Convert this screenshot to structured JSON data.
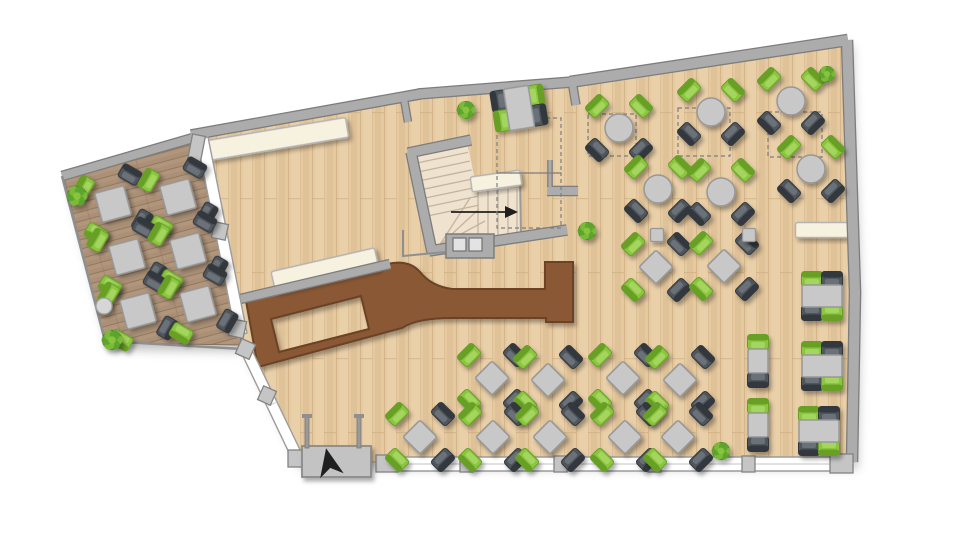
{
  "canvas": {
    "w": 960,
    "h": 556
  },
  "plan_title": "restaurant-floor-plan",
  "palette": {
    "floor": "#E5C9A1",
    "floorLine": "#C8A678",
    "floorLight": "#EFD9B3",
    "floorDark": "#DBBB90",
    "terrace": "#AB9077",
    "terraceLine": "#8A735A",
    "terraceBand": "#B79C80",
    "wall": "#ACACAC",
    "wallEdge": "#7D7D7D",
    "bar": "#8A5836",
    "barEdge": "#6B4226",
    "bench": "#F7F1DF",
    "benchEdge": "#B3B3B3",
    "table": "#C8C8C8",
    "tableEdge": "#979797",
    "chairGreen": "#8CC63F",
    "chairGreenBack": "#67A028",
    "chairGreenHi": "#A8D765",
    "chairDark": "#50565C",
    "chairDarkBack": "#33383D",
    "chairDarkHi": "#6E757D",
    "stair": "#EFE3D0",
    "stairLine": "#C3B49D",
    "window": "#FFFFFF",
    "windowFrame": "#9C9C9C",
    "block": "#C5C5C5",
    "blockEdge": "#838383",
    "mat": "#C3C3C3",
    "matEdge": "#8A8A8A",
    "arrow": "#1F1F1F",
    "dash": "#7E7E7E",
    "plantDark": "#44821F",
    "plantMid": "#5FA32E",
    "plantLight": "#7CBD3A",
    "plantTop": "#8CC63F"
  },
  "floorPoly": [
    [
      191,
      134
    ],
    [
      420,
      93
    ],
    [
      571,
      81
    ],
    [
      847,
      40
    ],
    [
      855,
      292
    ],
    [
      852,
      462
    ],
    [
      297,
      462
    ],
    [
      243,
      348
    ],
    [
      200,
      139
    ]
  ],
  "terracePoly": [
    [
      63,
      174
    ],
    [
      196,
      136
    ],
    [
      242,
      345
    ],
    [
      105,
      343
    ]
  ],
  "walls": [
    {
      "p": [
        [
          62,
          176
        ],
        [
          193,
          138
        ]
      ],
      "w": 8
    },
    {
      "p": [
        [
          191,
          135
        ],
        [
          420,
          94
        ]
      ],
      "w": 9
    },
    {
      "p": [
        [
          418,
          94
        ],
        [
          572,
          82
        ]
      ],
      "w": 9
    },
    {
      "p": [
        [
          570,
          82
        ],
        [
          848,
          40
        ]
      ],
      "w": 10
    },
    {
      "p": [
        [
          847,
          40
        ],
        [
          855,
          292
        ],
        [
          852,
          462
        ]
      ],
      "w": 10
    },
    {
      "p": [
        [
          404,
          99
        ],
        [
          408,
          122
        ]
      ],
      "w": 6
    },
    {
      "p": [
        [
          572,
          81
        ],
        [
          576,
          105
        ]
      ],
      "w": 7
    },
    {
      "p": [
        [
          236,
          300
        ],
        [
          390,
          264
        ]
      ],
      "w": 8
    },
    {
      "p": [
        [
          550,
          160
        ],
        [
          550,
          191
        ]
      ],
      "w": 3
    },
    {
      "p": [
        [
          547,
          191
        ],
        [
          578,
          191
        ]
      ],
      "w": 8
    },
    {
      "p": [
        [
          411,
          152
        ],
        [
          432,
          252
        ]
      ],
      "w": 9
    },
    {
      "p": [
        [
          408,
          153
        ],
        [
          471,
          140
        ]
      ],
      "w": 9
    },
    {
      "p": [
        [
          429,
          251
        ],
        [
          567,
          230
        ]
      ],
      "w": 9
    }
  ],
  "thinLines": [
    {
      "p": [
        [
          62,
          176
        ],
        [
          105,
          341
        ],
        [
          242,
          349
        ]
      ],
      "w": 2.5
    },
    {
      "p": [
        [
          403,
          230
        ],
        [
          403,
          256
        ],
        [
          445,
          252
        ]
      ],
      "w": 2
    }
  ],
  "nook": {
    "rect": [
      446,
      234,
      48,
      24
    ],
    "squares": [
      [
        453,
        238,
        13,
        13
      ],
      [
        469,
        238,
        13,
        13
      ]
    ]
  },
  "windows": {
    "bands": [
      {
        "poly": [
          [
            197,
            140
          ],
          [
            208,
            137
          ],
          [
            247,
            333
          ],
          [
            236,
            336
          ]
        ]
      },
      {
        "poly": [
          [
            241,
            352
          ],
          [
            251,
            348
          ],
          [
            303,
            456
          ],
          [
            293,
            461
          ]
        ]
      },
      {
        "poly": [
          [
            398,
            457
          ],
          [
            832,
            457
          ],
          [
            832,
            471
          ],
          [
            398,
            471
          ]
        ]
      }
    ],
    "blocks": [
      [
        190,
        135,
        13,
        26,
        11
      ],
      [
        213,
        223,
        14,
        16,
        12
      ],
      [
        230,
        320,
        15,
        17,
        12
      ],
      [
        238,
        341,
        15,
        16,
        24
      ],
      [
        260,
        388,
        14,
        15,
        24
      ],
      [
        288,
        450,
        16,
        17,
        0
      ],
      [
        376,
        455,
        22,
        17,
        0
      ],
      [
        830,
        454,
        23,
        19,
        0
      ],
      [
        460,
        456,
        13,
        16,
        0
      ],
      [
        554,
        456,
        13,
        16,
        0
      ],
      [
        648,
        456,
        13,
        16,
        0
      ],
      [
        742,
        456,
        13,
        16,
        0
      ]
    ]
  },
  "entrance": {
    "mat": [
      302,
      446,
      69,
      31
    ],
    "dart": {
      "cx": 329,
      "cy": 462,
      "rot": -12
    },
    "posts": [
      [
        305,
        416,
        4,
        32
      ],
      [
        357,
        416,
        4,
        32
      ]
    ],
    "caps": [
      [
        302,
        414,
        10,
        4
      ],
      [
        354,
        414,
        10,
        4
      ]
    ]
  },
  "bar": {
    "outer": "M246,301 L387,264 Q409,259 420,272 Q431,286 452,289 L545,289 L545,262 L573,262 L573,322 L546,322 L546,318 L452,318 Q417,318 402,328 L258,367 Z",
    "hole": "M271,319 L361,296 L369,329 L279,352 Z"
  },
  "benches": [
    [
      277,
      139,
      142,
      20,
      -9.5
    ],
    [
      325,
      270,
      106,
      21,
      -13
    ],
    [
      496,
      181,
      50,
      15,
      -8
    ],
    [
      824,
      230,
      57,
      15,
      0
    ]
  ],
  "stairs": {
    "inner": [
      [
        416,
        153
      ],
      [
        467,
        142
      ],
      [
        487,
        238
      ],
      [
        436,
        249
      ]
    ],
    "channel": [
      [
        460,
        188
      ],
      [
        521,
        188
      ],
      [
        521,
        236
      ],
      [
        460,
        245
      ]
    ],
    "p0": [
      416,
      153
    ],
    "u": [
      0.978,
      -0.205
    ],
    "v": [
      0.205,
      0.978
    ],
    "across": 51,
    "upperTreads": [
      10,
      19,
      28,
      37,
      46,
      55,
      64
    ],
    "fan": [
      [
        [
          439,
          246
        ],
        [
          470,
          198
        ]
      ],
      [
        [
          439,
          246
        ],
        [
          479,
          209
        ]
      ],
      [
        [
          439,
          246
        ],
        [
          485,
          221
        ]
      ]
    ],
    "lowerTreads": [
      478,
      488,
      498,
      508,
      517
    ],
    "rail": [
      [
        520,
        178
      ],
      [
        521,
        237
      ]
    ],
    "arrow": {
      "from": [
        451,
        212
      ],
      "to": [
        505,
        212
      ]
    }
  },
  "dashedZones": [
    [
      588,
      114,
      48,
      42
    ],
    [
      678,
      108,
      52,
      48
    ],
    [
      768,
      112,
      54,
      45
    ],
    [
      497,
      118,
      64,
      55
    ],
    [
      497,
      173,
      64,
      55
    ]
  ],
  "modules": {
    "sq4": {
      "table": {
        "k": "sq",
        "s": 30,
        "rot": 0
      },
      "chairs": [
        [
          -24,
          -24,
          -45,
          "g"
        ],
        [
          24,
          -24,
          45,
          "d"
        ],
        [
          -24,
          24,
          -135,
          "g"
        ],
        [
          24,
          24,
          135,
          "d"
        ]
      ]
    },
    "dia4": {
      "table": {
        "k": "sq",
        "s": 24,
        "rot": 45
      },
      "chairs": [
        [
          -23,
          -23,
          -45,
          "g"
        ],
        [
          23,
          -23,
          45,
          "d"
        ],
        [
          -23,
          23,
          -135,
          "g"
        ],
        [
          23,
          23,
          135,
          "d"
        ]
      ]
    },
    "rnd4": {
      "table": {
        "k": "rd",
        "r": 14
      },
      "chairs": [
        [
          -22,
          -22,
          -45,
          "g"
        ],
        [
          22,
          -22,
          45,
          "g"
        ],
        [
          -22,
          22,
          -135,
          "d"
        ],
        [
          22,
          22,
          135,
          "d"
        ]
      ]
    },
    "rect4h": {
      "table": {
        "k": "rc",
        "w": 40,
        "h": 22
      },
      "chairs": [
        [
          -10,
          -17,
          0,
          "g"
        ],
        [
          10,
          -17,
          0,
          "d"
        ],
        [
          -10,
          17,
          180,
          "d"
        ],
        [
          10,
          17,
          180,
          "g"
        ]
      ]
    },
    "sq2": {
      "table": {
        "k": "rc",
        "w": 20,
        "h": 24
      },
      "chairs": [
        [
          0,
          -19,
          0,
          "g"
        ],
        [
          0,
          19,
          180,
          "d"
        ]
      ]
    },
    "tt4": {
      "table": {
        "k": "rc",
        "w": 25,
        "h": 42
      },
      "chairs": [
        [
          -19,
          -10,
          -90,
          "d"
        ],
        [
          -19,
          10,
          -90,
          "g"
        ],
        [
          19,
          -10,
          90,
          "g"
        ],
        [
          19,
          10,
          90,
          "d"
        ]
      ]
    }
  },
  "furniture": {
    "sq4": {
      "rot": -15,
      "at": [
        [
          113,
          204
        ],
        [
          178,
          197
        ],
        [
          127,
          257
        ],
        [
          188,
          251
        ],
        [
          138,
          311
        ],
        [
          198,
          304
        ]
      ]
    },
    "rnd4": {
      "rot": 0,
      "at": [
        [
          619,
          128
        ],
        [
          711,
          112
        ],
        [
          791,
          101
        ],
        [
          658,
          189
        ],
        [
          721,
          192
        ],
        [
          811,
          169
        ]
      ]
    },
    "dia4": {
      "rot": 0,
      "at": [
        [
          656,
          267
        ],
        [
          724,
          266
        ],
        [
          492,
          378
        ],
        [
          548,
          380
        ],
        [
          623,
          378
        ],
        [
          680,
          380
        ],
        [
          420,
          437
        ],
        [
          493,
          437
        ],
        [
          550,
          437
        ],
        [
          625,
          437
        ],
        [
          678,
          437
        ]
      ]
    },
    "tt4": {
      "rot": -9,
      "at": [
        [
          519,
          108
        ]
      ]
    },
    "rect4h": {
      "rot": 0,
      "at": [
        [
          822,
          296
        ],
        [
          822,
          366
        ],
        [
          819,
          431
        ]
      ]
    },
    "sq2": {
      "rot": 0,
      "at": [
        [
          758,
          361
        ],
        [
          758,
          425
        ]
      ]
    }
  },
  "stools": {
    "size": 13,
    "at": [
      [
        657,
        235
      ],
      [
        749,
        235
      ]
    ]
  },
  "sideTable": {
    "x": 104,
    "y": 306,
    "r": 8
  },
  "plants": [
    [
      77,
      196,
      10
    ],
    [
      112,
      340,
      10
    ],
    [
      466,
      110,
      9
    ],
    [
      587,
      231,
      9
    ],
    [
      827,
      74,
      8
    ],
    [
      721,
      451,
      9
    ]
  ]
}
